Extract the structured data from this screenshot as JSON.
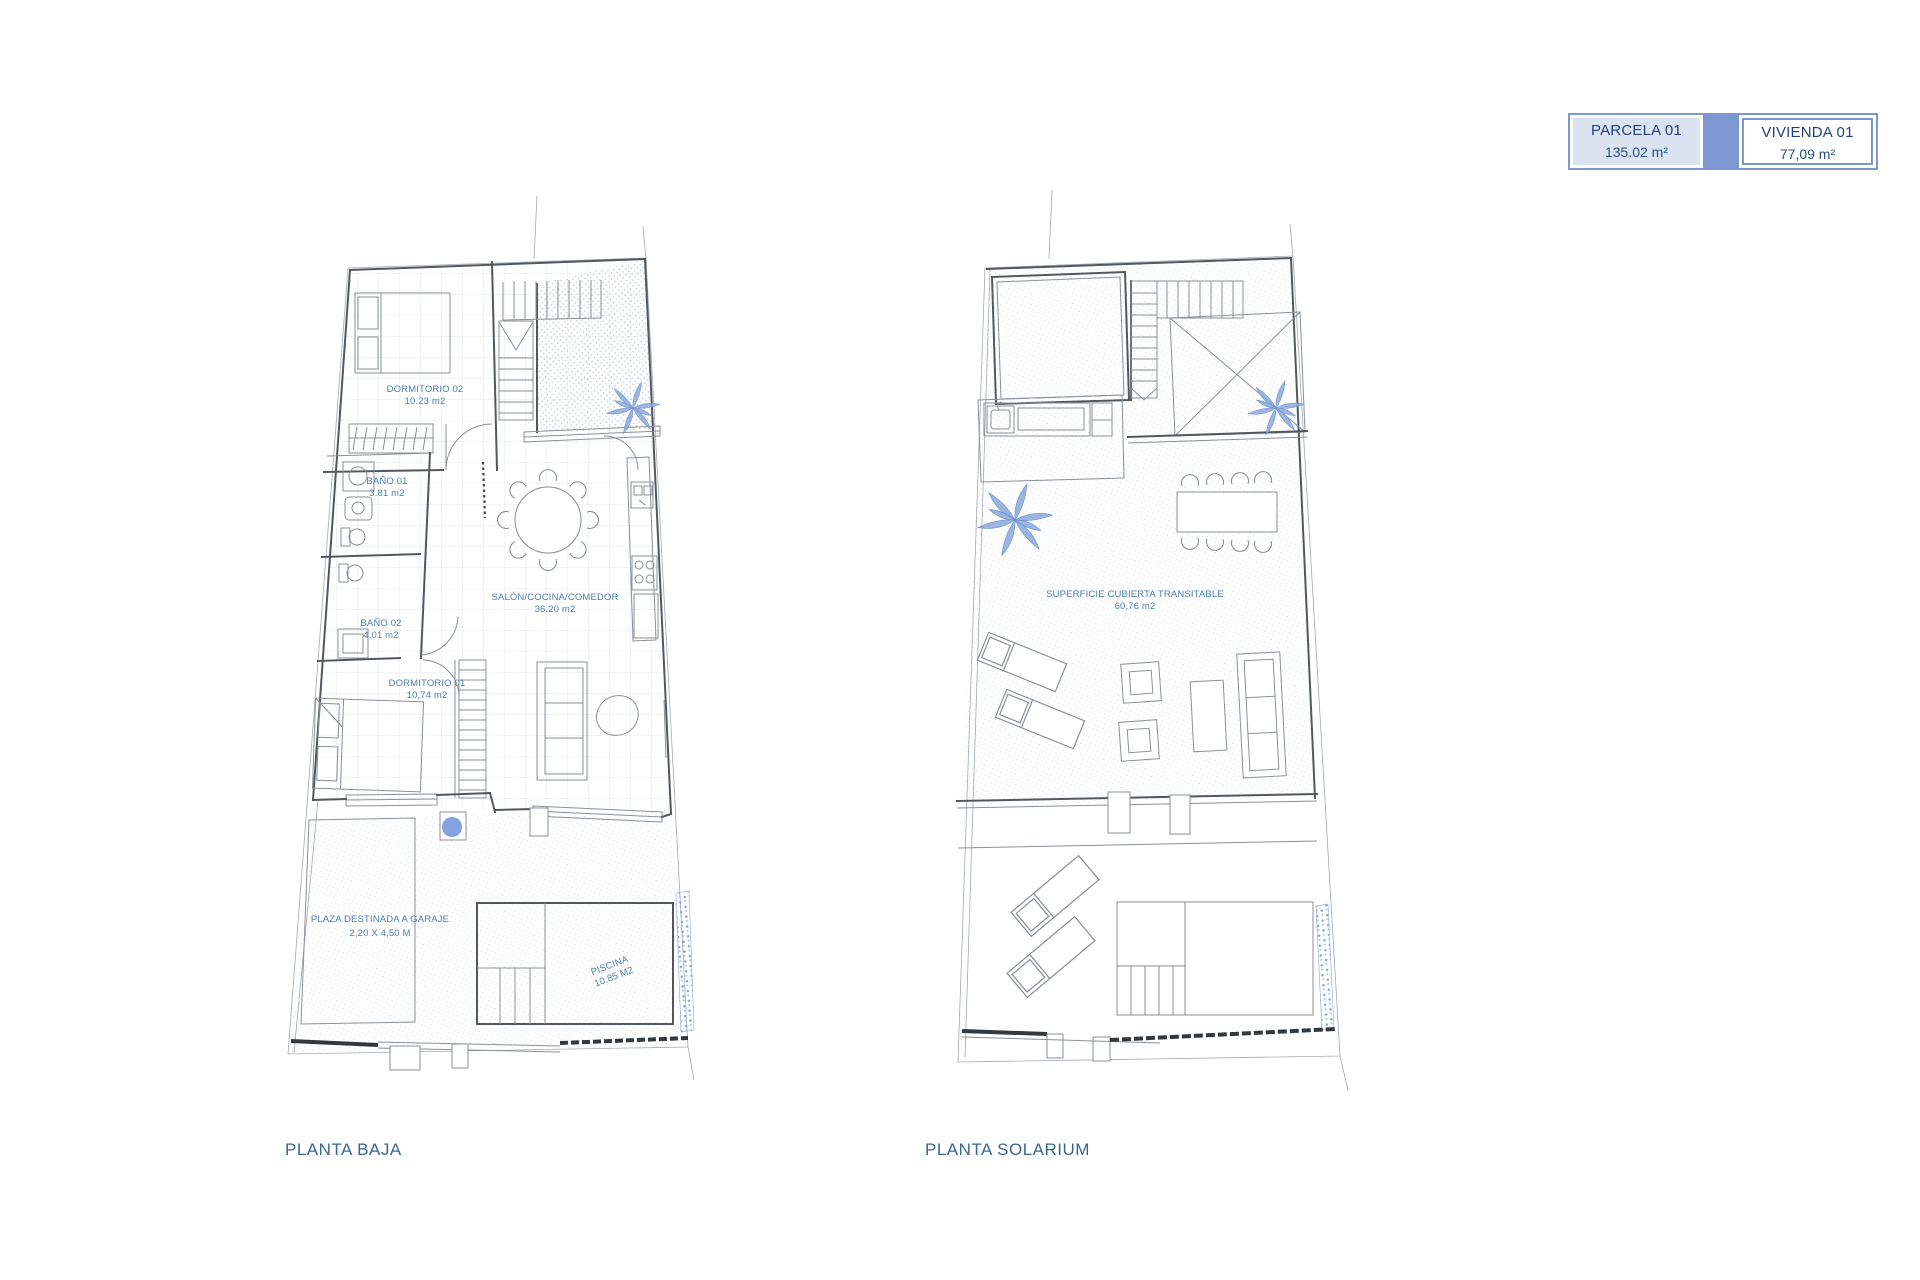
{
  "legend": {
    "parcela_title": "PARCELA 01",
    "parcela_area": "135.02 m²",
    "vivienda_title": "VIVIENDA 01",
    "vivienda_area": "77,09 m²"
  },
  "planta_baja": {
    "title": "PLANTA BAJA",
    "labels": {
      "dormitorio02": {
        "name": "DORMITORIO 02",
        "area": "10.23 m2"
      },
      "bano01": {
        "name": "BAÑO 01",
        "area": "3.81 m2"
      },
      "bano02": {
        "name": "BAÑO 02",
        "area": "4,01 m2"
      },
      "salon": {
        "name": "SALÓN/COCINA/COMEDOR",
        "area": "36.20 m2"
      },
      "dormitorio01": {
        "name": "DORMITORIO 01",
        "area": "10,74 m2"
      },
      "garaje": {
        "name": "PLAZA DESTINADA A GARAJE",
        "area": "2,20 X 4,50 M"
      },
      "piscina": {
        "name": "PISCINA",
        "area": "10.85 M2"
      }
    }
  },
  "planta_solarium": {
    "title": "PLANTA SOLARIUM",
    "labels": {
      "superficie": {
        "name": "SUPERFICIE CUBIERTA TRANSITABLE",
        "area": "60,76 m2"
      }
    }
  },
  "colors": {
    "accent_blue": "#7d97d2",
    "label_blue": "#4d80a5",
    "title_blue": "#38678e",
    "legend_text": "#23427c",
    "palm_blue": "#8aa8dc",
    "pool_fill": "#e9eff2"
  }
}
